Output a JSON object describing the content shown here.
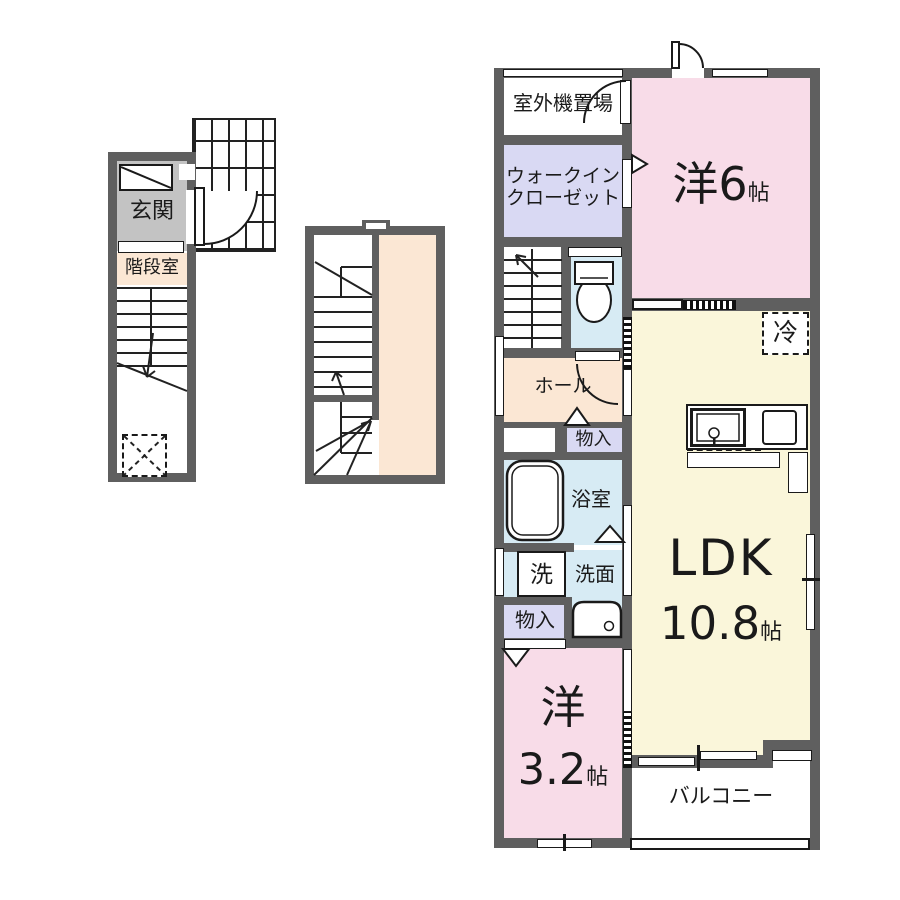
{
  "labels": {
    "genkan": "玄関",
    "stairwell": "階段室",
    "outdoor_unit": "室外機置場",
    "wic_line1": "ウォークイン",
    "wic_line2": "クローゼット",
    "hall": "ホール",
    "storage1": "物入",
    "bath": "浴室",
    "washer": "洗",
    "washstand": "洗面",
    "storage2": "物入",
    "fridge": "冷",
    "balcony": "バルコニー"
  },
  "rooms": {
    "western6": {
      "name": "洋6",
      "unit": "帖"
    },
    "ldk": {
      "name": "LDK",
      "size": "10.8",
      "unit": "帖"
    },
    "western32": {
      "name": "洋",
      "size": "3.2",
      "unit": "帖"
    }
  },
  "colors": {
    "wall": "#5f5f5f",
    "room_pink": "#f8dce8",
    "room_lavender": "#d9d9f3",
    "room_blue": "#d7ebf4",
    "room_cream": "#faf6da",
    "room_peach": "#fbe7d4",
    "entrance_gray": "#c3c3c3",
    "line": "#1a1a1a"
  }
}
